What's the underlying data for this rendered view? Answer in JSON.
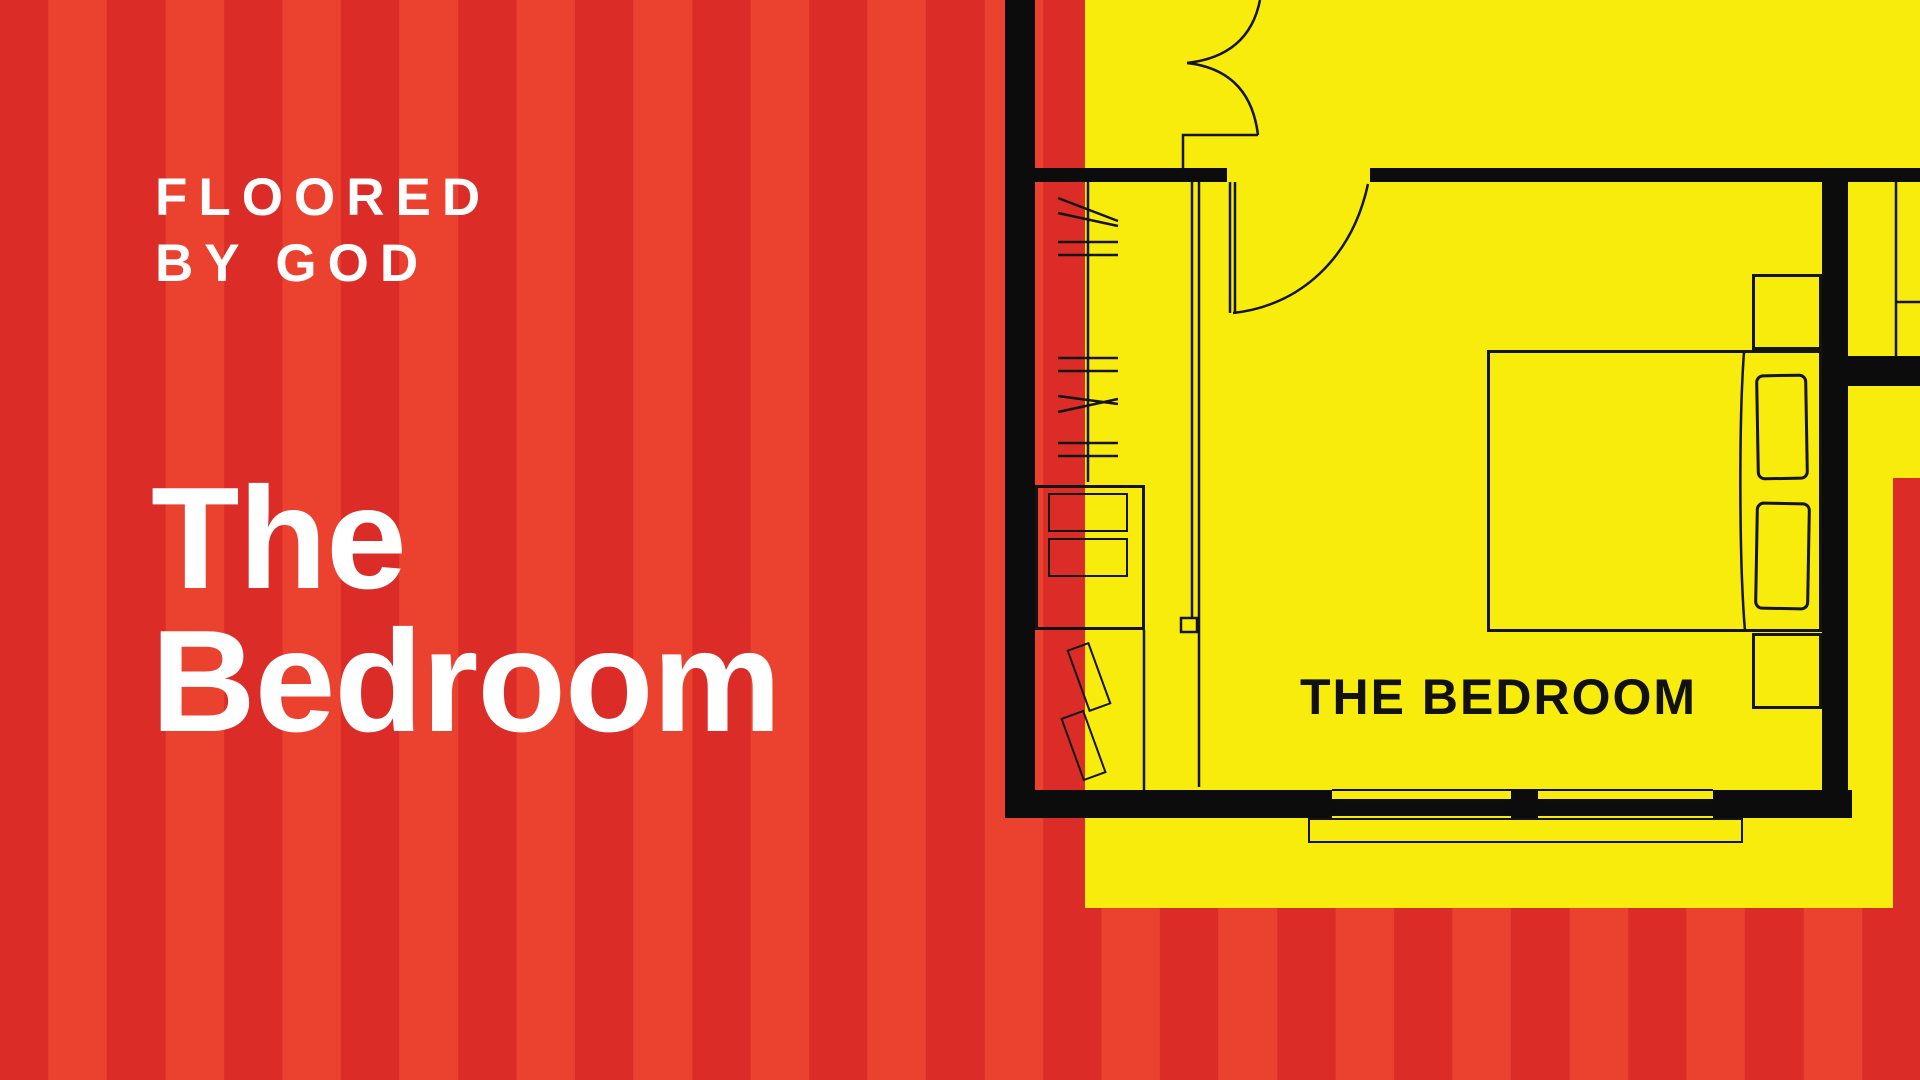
{
  "canvas": {
    "width": 1920,
    "height": 1080
  },
  "colors": {
    "stripe_dark_red": "#DC2C27",
    "stripe_light_red": "#EB4230",
    "panel_yellow": "#F8EC0C",
    "wall_black": "#0C0C0C",
    "line_black": "#141414",
    "text_white": "#FFFFFF",
    "label_black": "#111111"
  },
  "branding": {
    "logo_line1": "FLOORED",
    "logo_line2": "BY GOD",
    "logo_text": "FLOORED\nBY GOD"
  },
  "title": {
    "line1": "The",
    "line2": "Bedroom",
    "text": "The\nBedroom"
  },
  "floor_plan": {
    "room_label": "THE BEDROOM",
    "elements": [
      "left-wall",
      "top-wall",
      "right-wall",
      "bottom-wall-with-window",
      "entry-door-swing",
      "hall-door-swing",
      "closet-rod-with-hangers",
      "sliding-closet-door",
      "dresser-with-drawers",
      "two-leaning-boards",
      "double-bed",
      "two-pillows",
      "two-nightstands",
      "window-sill",
      "adjacent-room-closet"
    ]
  }
}
